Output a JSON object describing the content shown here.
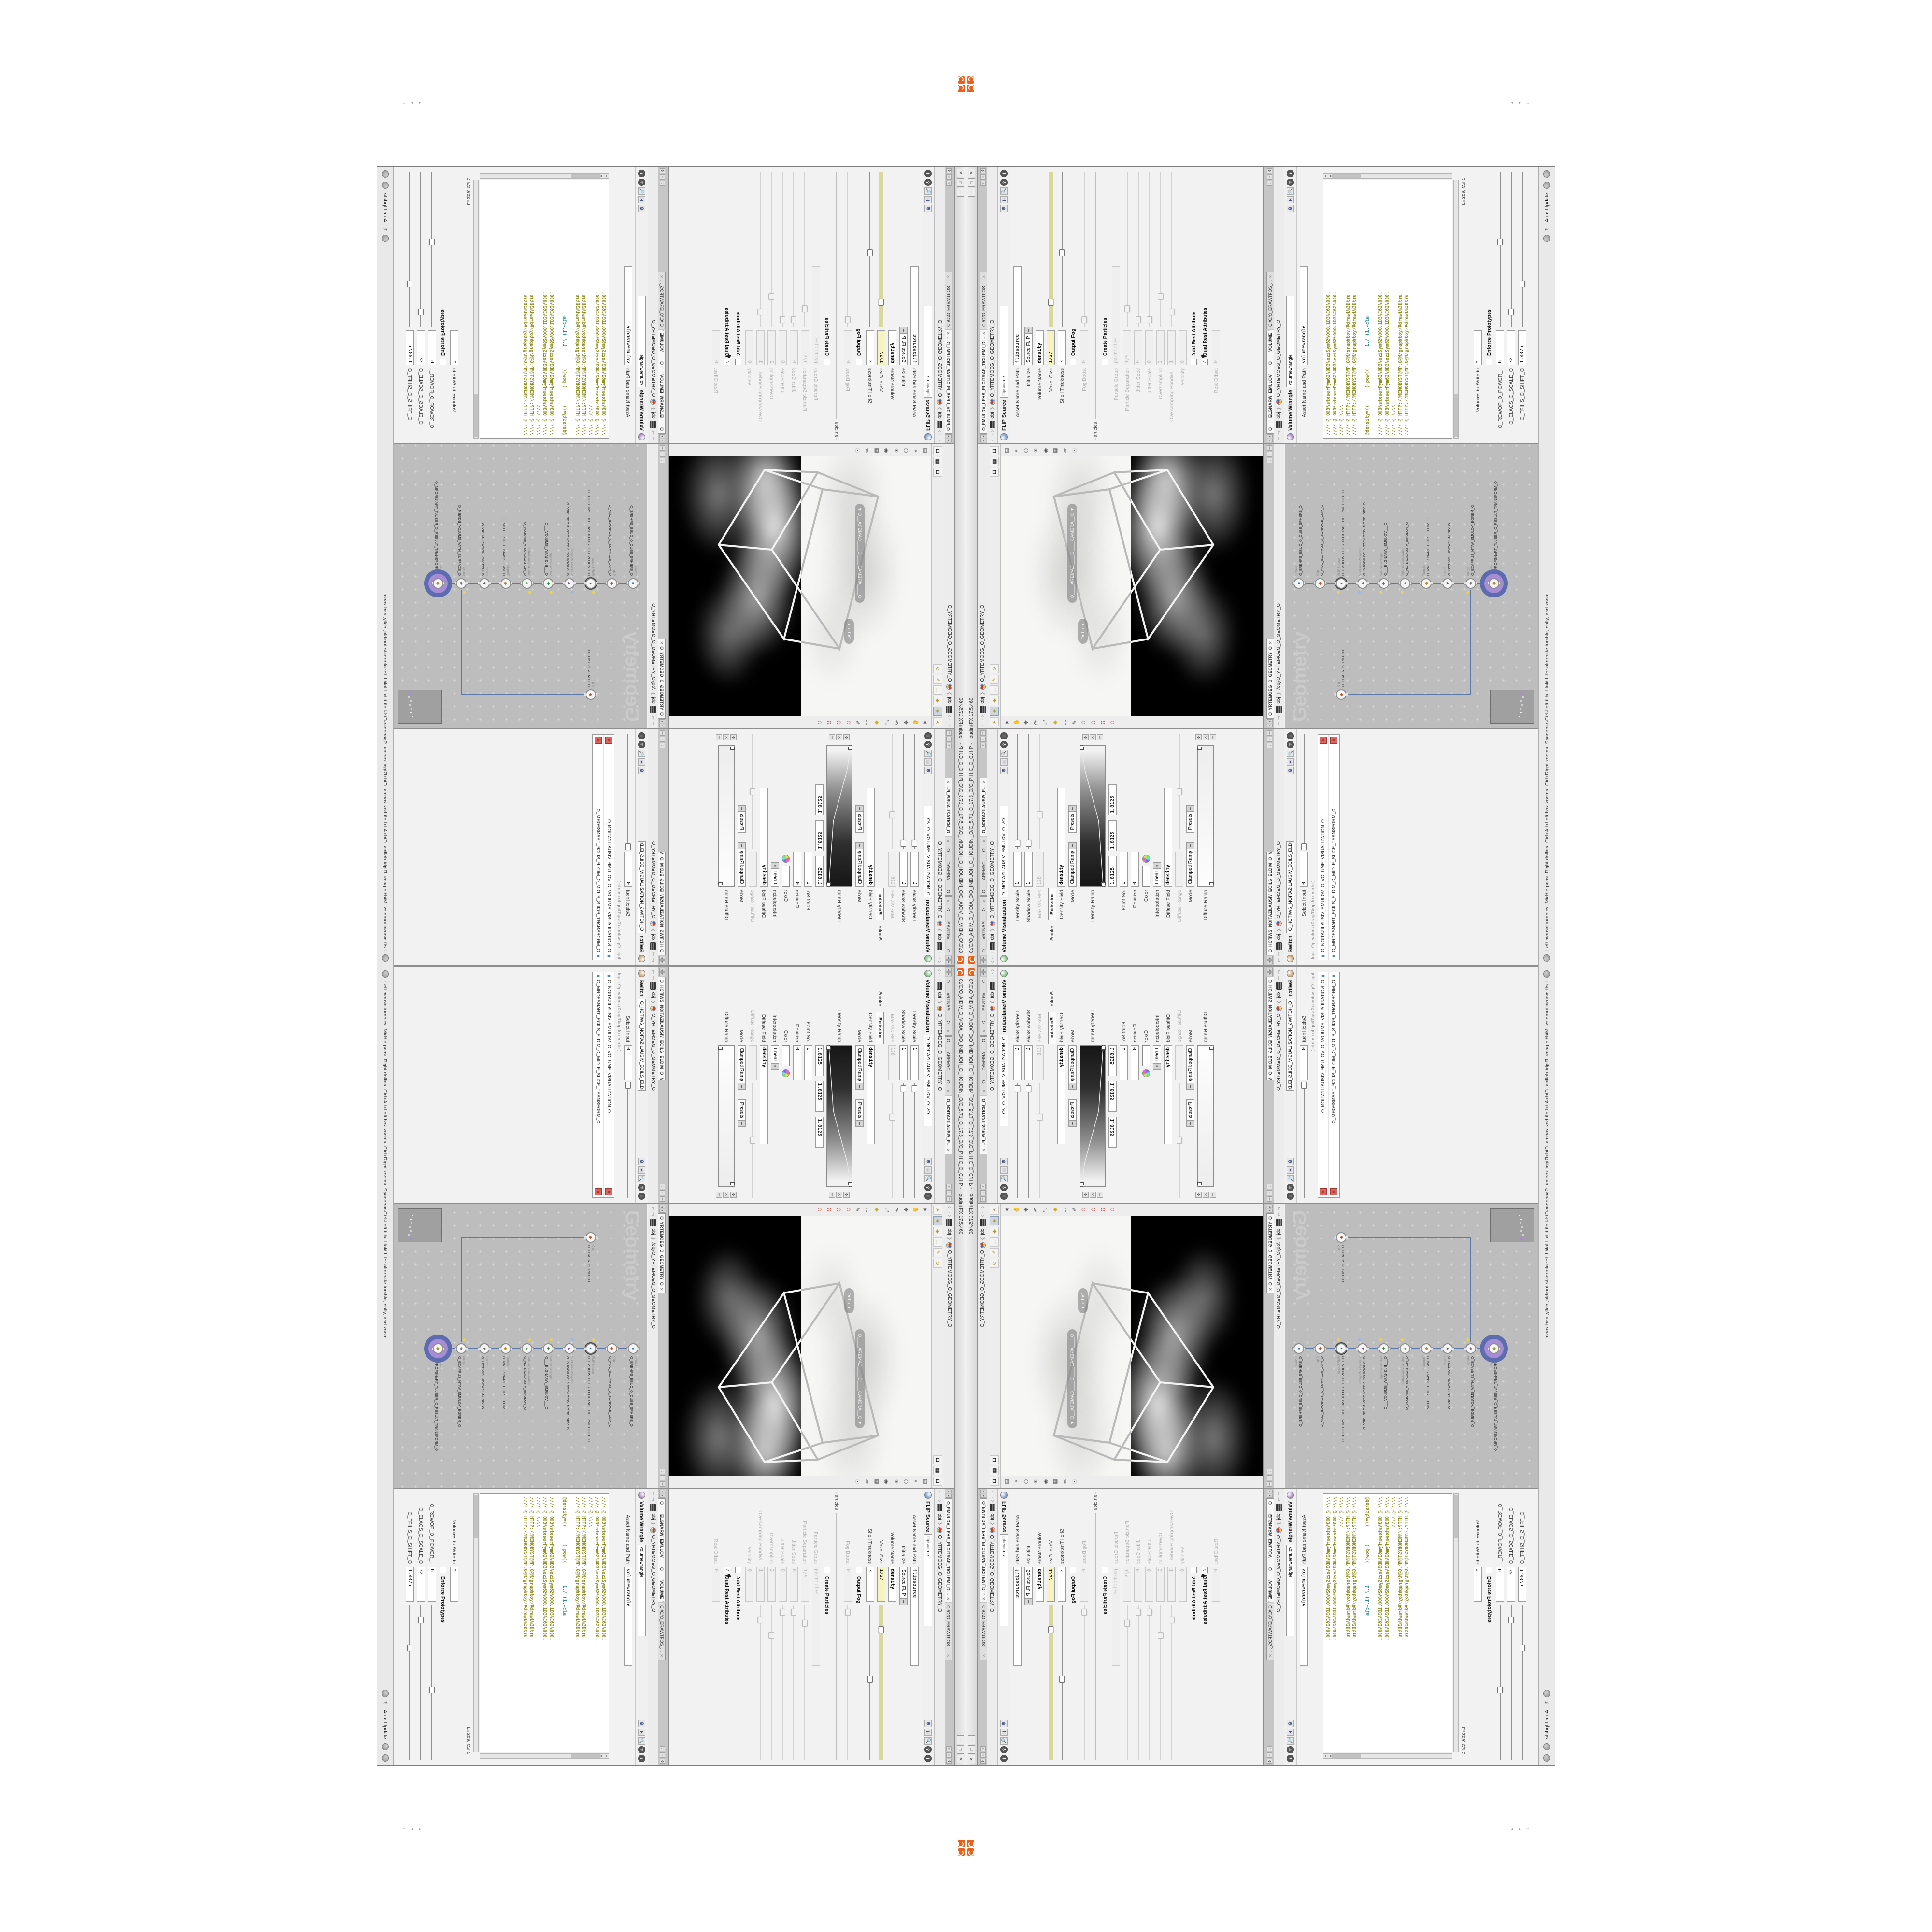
{
  "window": {
    "title": "C:/O/O_AIDIV_O_VIDIA_O/O_INIDUOH_O_HOUDINI_O/O_5.71_O_17.5_O/O_PIH.C_O_C.HIP - Houdini FX 17.5.460",
    "buttons": [
      "─",
      "□",
      "✕"
    ],
    "accent_orange": "#e8611c"
  },
  "breadcrumb": {
    "context": "obj",
    "path": "O_YRTEMOEG_O_GEOMETRY_O"
  },
  "volvis": {
    "tabs": [
      {
        "label": "O____ARTNAM____O...",
        "active": false
      },
      {
        "label": "O____AREMAC____O...",
        "active": false
      },
      {
        "label": "O_NOITAZILAUSIV_E...",
        "active": true
      }
    ],
    "title": "Volume Visualization",
    "name": "O_NOITAZILAUSIV_EMULOV_O_VO",
    "icon_color": "#49a04f",
    "subtabs": [
      "Smoke",
      "Emission"
    ],
    "active_subtab": "Emission",
    "rows": [
      {
        "label": "Density Scale",
        "type": "field",
        "value": "1",
        "slider": 0.05
      },
      {
        "label": "Shadow Scale",
        "type": "field",
        "value": "1",
        "slider": 0.05
      },
      {
        "label": "Max Vis Res",
        "type": "field",
        "value": "128",
        "grayed": true,
        "slider": 0.3,
        "sliderGray": true
      },
      {
        "type": "subtabs"
      },
      {
        "label": "Density Field",
        "type": "field",
        "value": "density",
        "bold": true,
        "wide": true
      },
      {
        "label": "Mode",
        "type": "drop2",
        "value": "Clamped Ramp",
        "value2": "Presets"
      },
      {
        "label": "Density Ramp",
        "type": "ramp",
        "dark": true
      },
      {
        "type": "triple",
        "values": [
          "1.8125",
          "1.8125",
          "1.8125"
        ]
      },
      {
        "label": "Point No.",
        "type": "field",
        "value": "1"
      },
      {
        "label": "Position",
        "type": "field",
        "value": "0"
      },
      {
        "label": "Color",
        "type": "color"
      },
      {
        "label": "Interpolation",
        "type": "drop",
        "value": "Linear"
      },
      {
        "label": "Diffuse Field",
        "type": "field",
        "value": "density",
        "bold": true,
        "wide": true
      },
      {
        "label": "Diffuse Range",
        "type": "field",
        "value": "",
        "grayed": true,
        "slider": 0.5,
        "sliderGray": true
      },
      {
        "label": "Mode",
        "type": "drop2",
        "value": "Clamped Ramp",
        "value2": "Presets"
      },
      {
        "label": "Diffuse Ramp",
        "type": "ramp",
        "dark": false
      }
    ]
  },
  "flip": {
    "tabs": [
      {
        "label": "O_EMULOV_LEHS_ELCITRAP_TICILPMI_DI...",
        "active": true
      },
      {
        "label": "C:/O/O_ERAWTFOS_...",
        "active": false
      }
    ],
    "title": "FLIP Source",
    "name": "flipsource",
    "icon_color": "#3f6fb5",
    "rows": [
      {
        "label": "Asset Name and Path",
        "type": "field",
        "value": "flipsource",
        "wide": true
      },
      {
        "label": "Initialize",
        "type": "drop",
        "value": "Source FLIP"
      },
      {
        "label": "Volume Name",
        "type": "field",
        "value": "density",
        "bold": true
      },
      {
        "label": "Voxel Size",
        "type": "field",
        "value": "1/27",
        "yellow": true,
        "slider": 0.16,
        "sliderYellow": true
      },
      {
        "label": "Shell Thickness",
        "type": "field",
        "value": "3",
        "slider": 0.48
      },
      {
        "type": "check",
        "label": "Output Fog",
        "checked": false
      },
      {
        "label": "Fog Boost",
        "type": "field",
        "value": "0",
        "grayed": true,
        "slider": 0.05,
        "sliderGray": true
      },
      {
        "type": "section",
        "label": "Particles"
      },
      {
        "type": "check",
        "label": "Create Particles",
        "checked": false
      },
      {
        "label": "Particle Group",
        "type": "field",
        "value": "particles",
        "grayed": true,
        "wide": true
      },
      {
        "label": "Particle Separation",
        "type": "field",
        "value": "1/9",
        "grayed": true,
        "slider": 0.12,
        "sliderGray": true
      },
      {
        "label": "Jitter Seed",
        "type": "field",
        "value": "0",
        "grayed": true,
        "slider": 0.05,
        "sliderGray": true
      },
      {
        "label": "Jitter Scale",
        "type": "field",
        "value": "0",
        "grayed": true,
        "slider": 0.05,
        "sliderGray": true
      },
      {
        "label": "Oversampling",
        "type": "field",
        "value": "2",
        "grayed": true,
        "slider": 0.2,
        "sliderGray": true
      },
      {
        "label": "Oversampling Bandwi...",
        "type": "field",
        "value": "1",
        "grayed": true,
        "slider": 0.1,
        "sliderGray": true
      },
      {
        "label": "Velocity",
        "type": "field",
        "value": "0",
        "grayed": true
      },
      {
        "type": "check",
        "label": "Add Rest Attribute",
        "checked": false
      },
      {
        "type": "check",
        "label": "Dual Rest Attributes",
        "checked": true,
        "cursor": true
      },
      {
        "label": "Rest Offset",
        "type": "field",
        "value": "0",
        "grayed": true
      }
    ]
  },
  "switch": {
    "tabs": [
      {
        "label": "O_HCTIWS_NOITAZILAUSIV_ECILS_ELDIM_O_MIDLE_SLICE_VISUALIZATION...",
        "active": true
      }
    ],
    "title": "Switch",
    "name": "O_HCTIWS_NOITAZILAUSIV_ECILS_ELDIM_O_",
    "icon_color": "#b0772a",
    "select_input_label": "Select Input",
    "select_input_value": "0",
    "list_label": "Input Operators (Drag/Drop to reorder)",
    "items": [
      "O_NOITAZILAUSIV_EMULOV_O_VOLUME_VISUALIZATION_O",
      "O_MROFSNART_ECILS_ELDIM_O_MIDLE_SLICE_TRANSFORM_O"
    ]
  },
  "wrangle": {
    "tabs": [
      {
        "label": "O____ELGNARW_EMULOV____O____VOLUME_WRANGL...",
        "active": true
      },
      {
        "label": "C:/O/O_ERAWTFOS_...",
        "active": false
      }
    ],
    "title": "Volume Wrangle",
    "name": "volumewrangle",
    "icon_color": "#7a4ab0",
    "asset_label": "Asset Name and Path",
    "code": [
      [
        {
          "t": "//// @ 0D3%steserPym62%0D3%eziSym62%000.1D3%C62%000.",
          "c": "o"
        }
      ],
      [
        {
          "t": "//// @ 0D3%steserPym62%0D3%eziSym62%000.1D3%C62%000.",
          "c": "o"
        }
      ],
      [
        {
          "t": "//// @ \\\\\\\\",
          "c": "o"
        }
      ],
      [
        {
          "t": "//// @ HTTP://MEMORYST@MP.C@M/graphtoy/#draw1%3Dtru",
          "c": "o"
        }
      ],
      [
        {
          "t": "//// @ HTTP://MEMORYST@MP.C@M/graphtoy/#draw1%3Dtru",
          "c": "o"
        }
      ],
      [
        {
          "t": " ",
          "c": "o"
        }
      ],
      [
        {
          "t": "@density=((      ((pow((        ",
          "c": "o"
        },
        {
          "t": "1./ (1.-cla",
          "c": "t"
        }
      ],
      [
        {
          "t": " ",
          "c": "o"
        }
      ],
      [
        {
          "t": "//// @ 0D3%steserPym62%0D3%eziSym62%000.1D3%C62%000.",
          "c": "o"
        }
      ],
      [
        {
          "t": "//// @ 0D3%steserPym62%0D3%eziSym62%000.1D3%C62%000.",
          "c": "o"
        }
      ],
      [
        {
          "t": "//// @ \\\\\\\\",
          "c": "o"
        }
      ],
      [
        {
          "t": "//// @ HTTP://MEMORYST@MP.C@M/graphtoy/#draw1%3Dtru",
          "c": "o"
        }
      ],
      [
        {
          "t": "//// @ HTTP://MEMORYST@MP.C@M/graphtoy/#draw1%3Dtru",
          "c": "o"
        }
      ]
    ],
    "cursor_status": "Ln 209, Col 1",
    "rows": [
      {
        "label": "Volumes to Write to",
        "type": "field",
        "value": "*"
      },
      {
        "type": "check",
        "label": "Enforce Prototypes",
        "checked": false
      },
      {
        "label": "O_REWOP_O_POWER_..",
        "type": "field",
        "value": "6",
        "slider": 0.55
      },
      {
        "label": "O_ELACS_O_SCALE_O",
        "type": "field",
        "value": "32",
        "slider": 0.1
      },
      {
        "label": "O_TFIHS_O_SHIFT_O",
        "type": "field",
        "value": "1.4375",
        "slider": 0.28
      }
    ]
  },
  "viewport": {
    "camera": "O____AREMAC____O____CAMERA__O",
    "ortho": "Ortho",
    "left_tools": [
      "select-arrow",
      "hand-tool",
      "translate-tool",
      "rotate-tool",
      "scale-tool",
      "secure-selection",
      "lasso-select",
      "brush-tool",
      "grid-snap-magnet",
      "point-snap-magnet",
      "edge-snap-magnet",
      "multi-snap-magnet"
    ],
    "right_tools": [
      "display-options",
      "shading-mode",
      "wireframe-toggle",
      "lighting-toggle",
      "camera-lock",
      "view-grid",
      "reference-plane",
      "snapshot"
    ]
  },
  "network": {
    "tab": "O_YRTEMOEG_O_GEOMETRY_O",
    "context": "obj",
    "path": "/obj/O_YRTEMOEG_O_GEOMETRY_O",
    "watermark": "Geometry",
    "nodes": [
      {
        "type": "Sphere",
        "name": "O_EREHPS_EBUC_O_CUBE_SPHERE_O",
        "glyph": "●",
        "gc": "#3a7abf"
      },
      {
        "type": "Clip",
        "name": "O_PILC_ECAFRUS_O_SURFACE_CLIP_O",
        "glyph": "◆",
        "gc": "#b05a2a"
      },
      {
        "type": "FLIP Source",
        "name": "O_EMULOV_LEHS_ELCITRAP_TICILPMI_DIULF_O",
        "glyph": "◐",
        "gc": "#2a6ab0",
        "dot": "y",
        "ring": true
      },
      {
        "type": "VDB from Polygons",
        "name": "O_SNOGILOP_YRTEMOEG_MORF_BDV_O",
        "glyph": "▲",
        "gc": "#7a4ab0",
        "dot": "b"
      },
      {
        "type": "Volume Wrangle",
        "name": "O___ELGNARW_EMULOV___O",
        "glyph": "✚",
        "gc": "#3a8a4a",
        "dot": "y"
      },
      {
        "type": "Volume Visualization",
        "name": "O_NOITAZILAUSIV_EMULOV_O",
        "glyph": "●",
        "gc": "#49a04f",
        "dot": "y"
      },
      {
        "type": "Transform",
        "name": "O_MROFSNART_ECILS_ELDIM_O",
        "glyph": "◆",
        "gc": "#b0922a"
      },
      {
        "type": "Switch",
        "name": "O_HCTIWS_NOITAZILAUSIV_O",
        "glyph": "▼",
        "gc": "#555555"
      },
      {
        "type": "Merge",
        "name": "O_ECAFRUS_HTIW_EMULOV_EGREM_O",
        "glyph": "★",
        "gc": "#777777",
        "dot": "y"
      },
      {
        "type": "Transform",
        "name": "O_MROFSNART_TLUSER_O_RESULT_TRANSFORM_O",
        "glyph": "◆",
        "gc": "#b0922a",
        "halo": true
      }
    ],
    "side_node": {
      "type": "Clip",
      "name": "O_ECAFRUS_PILC_O",
      "glyph": "◆",
      "gc": "#b05a2a"
    },
    "wire_color": "#5b78a8",
    "badge_yellow": "#e8d44d",
    "badge_blue": "#9ab7e8",
    "halo_outer": "#5d6cae",
    "halo_inner": "#a78cd6"
  },
  "statusbar": {
    "help": "Left mouse tumbles. Middle pans. Right dollies. Ctrl+Alt+Left box zooms. Ctrl+Right zooms. Spacebar-Ctrl-Left tilts. Hold L for alternate tumble, dolly, and zoom.",
    "auto_update": "Auto Update"
  }
}
